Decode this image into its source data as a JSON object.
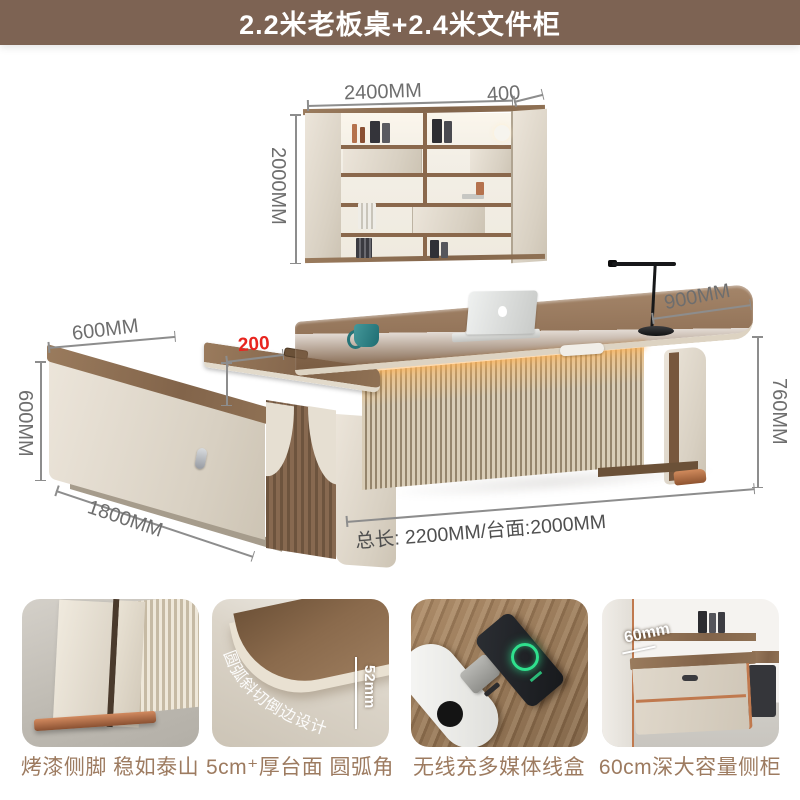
{
  "banner": {
    "title": "2.2米老板桌+2.4米文件柜"
  },
  "bookshelf": {
    "width_label": "2400MM",
    "depth_label": "400",
    "height_label": "2000MM"
  },
  "desk": {
    "cabinet_depth_label": "600MM",
    "overhang_label": "200",
    "cabinet_height_label": "600MM",
    "cabinet_length_label": "1800MM",
    "top_depth_label": "900MM",
    "height_label": "760MM",
    "total_length_label": "总长: 2200MM/台面:2000MM"
  },
  "features": [
    {
      "caption": "烤漆侧脚 稳如泰山"
    },
    {
      "caption": "5cm⁺厚台面 圆弧角",
      "arc_text": "圆弧斜切倒边设计",
      "thickness_label": "52mm"
    },
    {
      "caption": "无线充多媒体线盒"
    },
    {
      "caption": "60cm深大容量侧柜",
      "depth_label": "60mm"
    }
  ],
  "colors": {
    "banner_bg": "#7d6353",
    "caption": "#9d7b60",
    "dimension": "#6e6e6e",
    "highlight": "#e8251f",
    "wood": "#8a6a4e",
    "cream": "#e2dbcf",
    "copper": "#b5744e",
    "teal": "#2b7f82"
  }
}
